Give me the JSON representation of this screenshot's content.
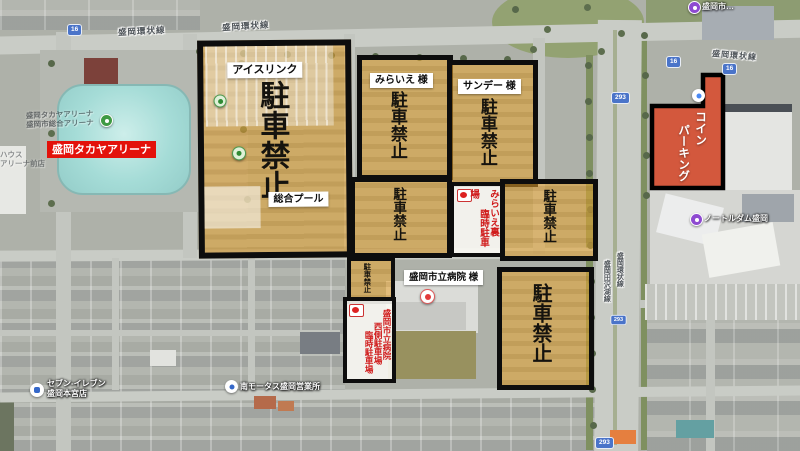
{
  "zones": {
    "icerink": {
      "facility_top": "アイスリンク",
      "no_parking": "駐車禁止",
      "facility_bottom": "総合プール"
    },
    "miraie": {
      "facility": "みらいえ 様",
      "no_parking": "駐車禁止"
    },
    "sunday": {
      "facility": "サンデー 様",
      "no_parking": "駐車禁止"
    },
    "mid_left": {
      "no_parking": "駐車禁止"
    },
    "mid_right": {
      "no_parking": "駐車禁止"
    },
    "small": {
      "no_parking": "駐車禁止"
    },
    "south": {
      "no_parking": "駐車禁止"
    },
    "temp_miraie": {
      "col1": "みらいえ裏",
      "col2": "臨時駐車場"
    },
    "hospital_west": {
      "col1": "盛岡市立病院",
      "col2": "西側駐車場",
      "col3": "臨時駐車場"
    },
    "coin": {
      "col1": "コイン",
      "col2": "パーキング"
    }
  },
  "banners": {
    "arena": "盛岡タカヤアリーナ",
    "hospital": "盛岡市立病院 様"
  },
  "roads": {
    "ring": "盛岡環状線",
    "tazawako": "盛岡田沢湖線",
    "route16": "16",
    "route293": "293"
  },
  "pois": {
    "seven1": "セブン-イレブン",
    "seven2": "盛岡本宮店",
    "motors": "南モータス盛岡営業所",
    "notredame": "ノートルダム盛岡",
    "top_right": "盛岡市…",
    "arena_base1": "盛岡タカヤアリーナ",
    "arena_base2": "盛岡市総合アリーナ",
    "shop1": "ハウス",
    "shop2": "アリーナ前店"
  },
  "colors": {
    "zone_fill": "#e8a430",
    "zone_border": "#0d0d0d",
    "coin_parking_fill": "#d84b2d",
    "arena_banner_bg": "#e3120b",
    "warning_text_red": "#d01b1b",
    "route_shield_blue": "#4a74c9"
  }
}
